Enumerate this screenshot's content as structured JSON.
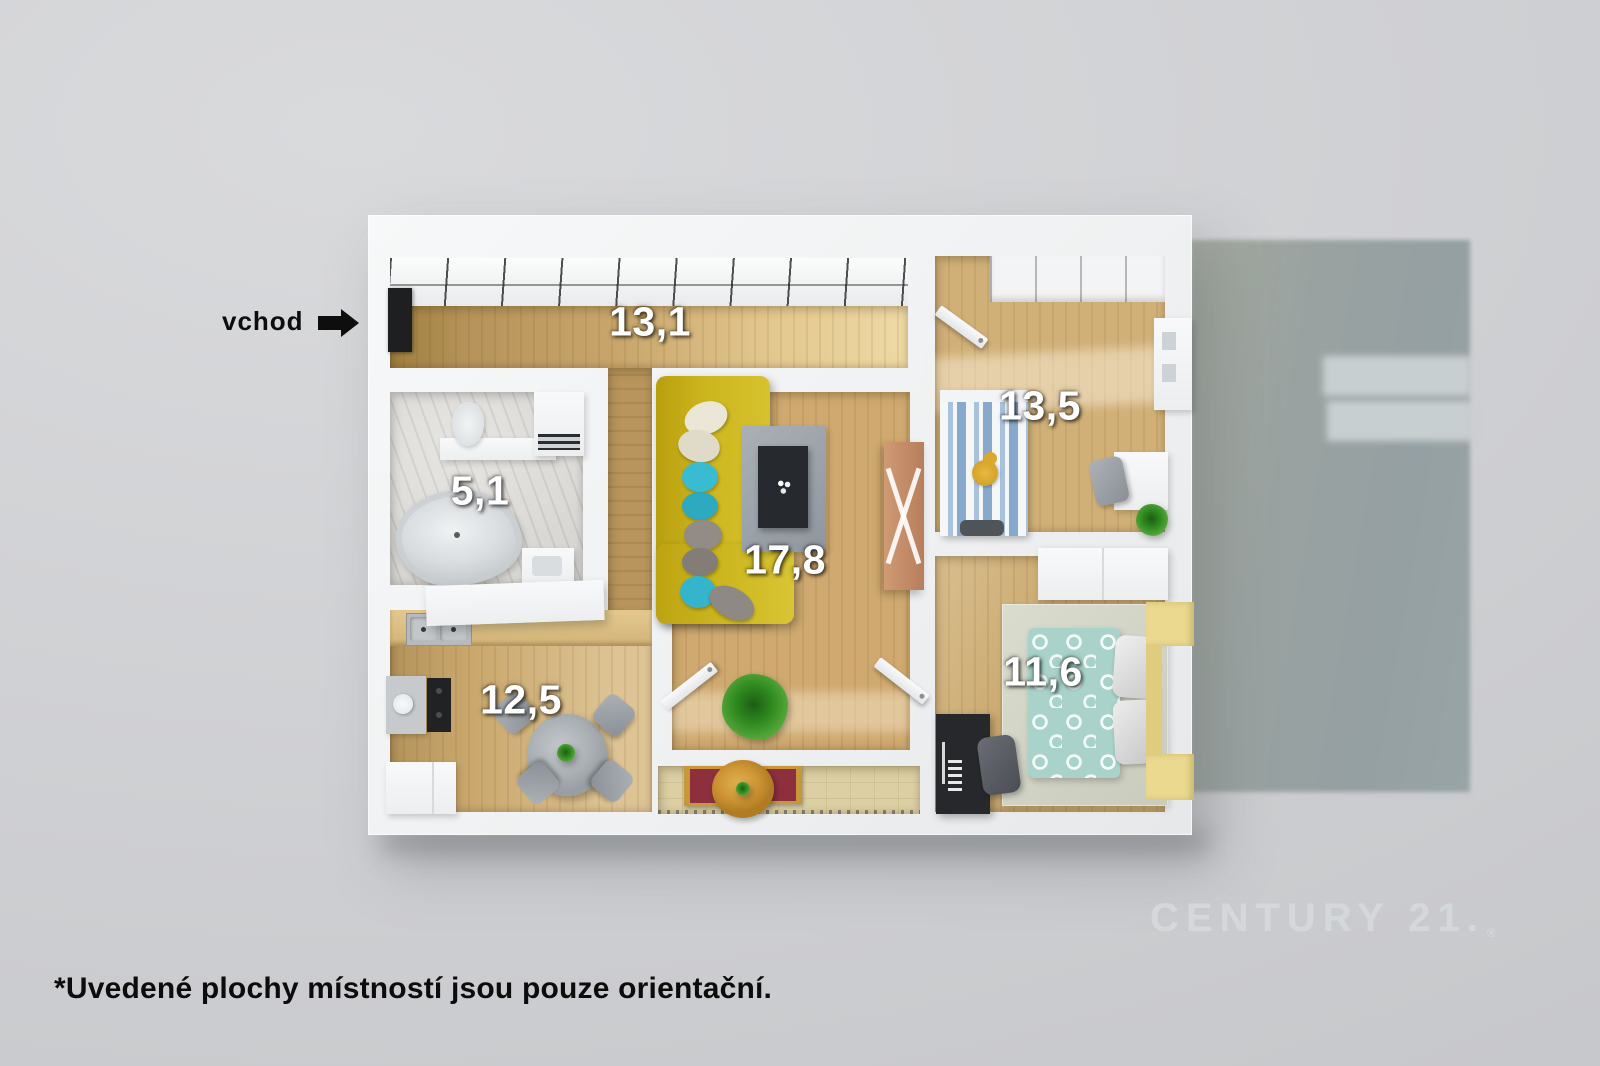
{
  "entrance": {
    "label": "vchod"
  },
  "rooms": {
    "hallway": {
      "area": "13,1"
    },
    "bathroom": {
      "area": "5,1"
    },
    "living_room": {
      "area": "17,8"
    },
    "kitchen": {
      "area": "12,5"
    },
    "bedroom_upper": {
      "area": "13,5"
    },
    "bedroom_lower": {
      "area": "11,6"
    }
  },
  "watermark": {
    "text": "CENTURY 21.",
    "registered": "®"
  },
  "footnote": "*Uvedené plochy místností jsou pouze orientační.",
  "palette": {
    "background": "#d0d1d4",
    "wall_white": "#f3f4f5",
    "wood_floor": "#c9a76c",
    "marble_floor": "#d4d2ce",
    "sofa_yellow": "#cdb71f",
    "pillow_teal": "#35b8cf",
    "bed_stripe_blue": "#8fb0d4",
    "bed_teal": "#a9d3ca",
    "bench_red": "#8e2f3e",
    "balcony_tile": "#dbcfa3",
    "cast_shadow": "#9aa2a1",
    "label_text": "#ffffff",
    "ink": "#0d0d0d",
    "watermark_gray": "#d7dadc"
  }
}
